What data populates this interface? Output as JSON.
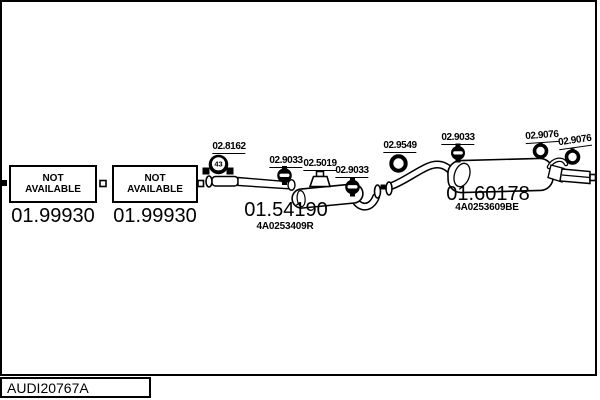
{
  "title_block": {
    "code": "AUDI20767A"
  },
  "not_available": {
    "line1": "NOT",
    "line2": "AVAILABLE",
    "boxes": [
      {
        "part_number": "01.99930"
      },
      {
        "part_number": "01.99930"
      }
    ]
  },
  "parts": {
    "middle_muffler": {
      "part_number": "01.54190",
      "oem_ref": "4A0253409R"
    },
    "rear_muffler": {
      "part_number": "01.60178",
      "oem_ref": "4A0253609BE"
    }
  },
  "fittings": [
    {
      "code": "02.8162",
      "type": "clamp",
      "clamp_size": "43"
    },
    {
      "code": "02.9033",
      "type": "hanger"
    },
    {
      "code": "02.5019",
      "type": "rubber-mount"
    },
    {
      "code": "02.9033",
      "type": "hanger"
    },
    {
      "code": "02.9549",
      "type": "gasket-ring"
    },
    {
      "code": "02.9033",
      "type": "hanger"
    },
    {
      "code": "02.9076",
      "type": "hanger-ring"
    },
    {
      "code": "02.9076",
      "type": "hanger-ring"
    }
  ],
  "colors": {
    "line": "#000000",
    "background": "#ffffff"
  }
}
